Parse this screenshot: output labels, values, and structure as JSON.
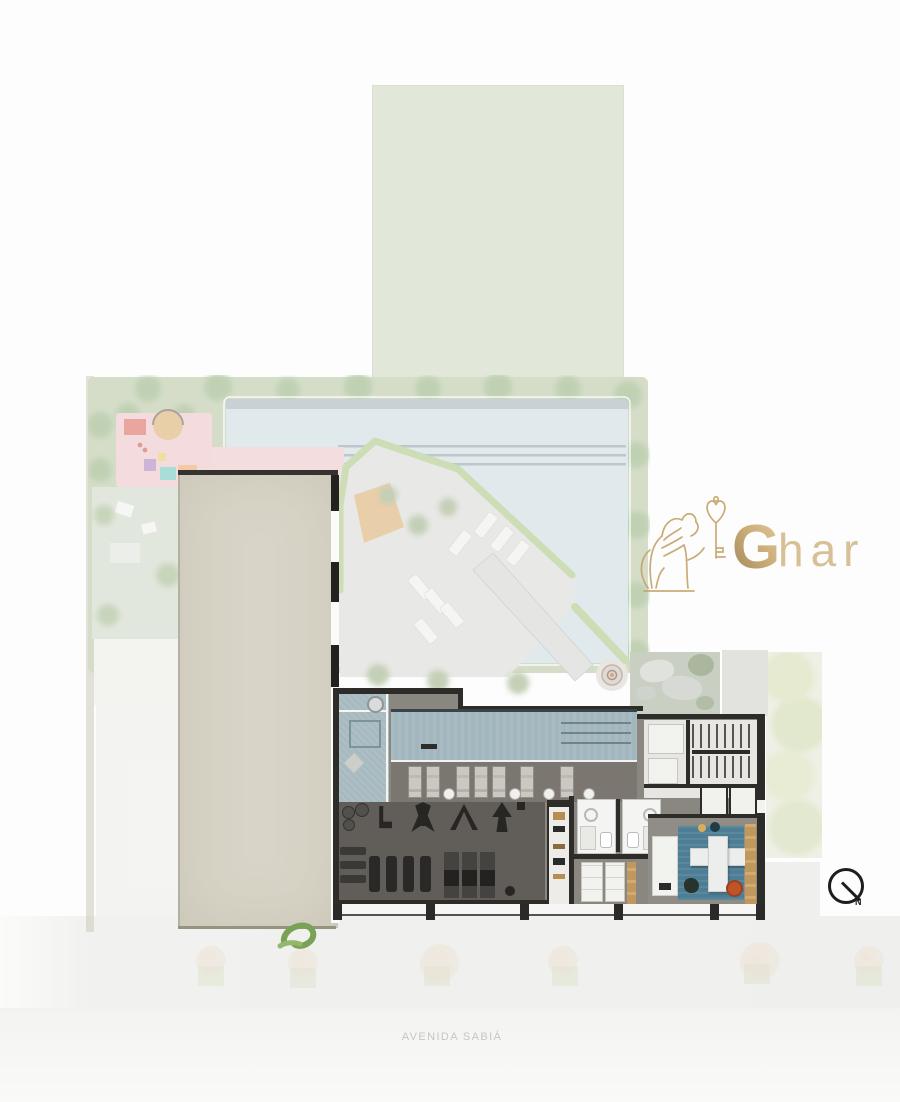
{
  "page": {
    "type": "architectural ground-floor site plan rendering",
    "street_label": "AVENIDA SABIÁ"
  },
  "logo": {
    "brand_initial": "G",
    "brand_rest": "har",
    "icon": "lion-holding-key-icon",
    "gold_dark": "#8f7342",
    "gold_mid": "#c6a468",
    "gold_light": "#e0c794"
  },
  "compass": {
    "icon": "north-compass-icon",
    "north_label": "N"
  },
  "palette": {
    "tower_beige": "#d8d4c7",
    "outdoor_pool_water": "#c9d9df",
    "indoor_lap_pool": "#a2b6bd",
    "hedge_green": "#a6c47c",
    "playground_pink": "#eec4c6",
    "gym_floor": "#615e5a",
    "wall_dark": "#2e2c29",
    "lounge_rug_blue": "#4d7e95",
    "wood_tan": "#c0975c",
    "pouf_orange": "#c05327",
    "street_text": "#c6c6c4"
  }
}
